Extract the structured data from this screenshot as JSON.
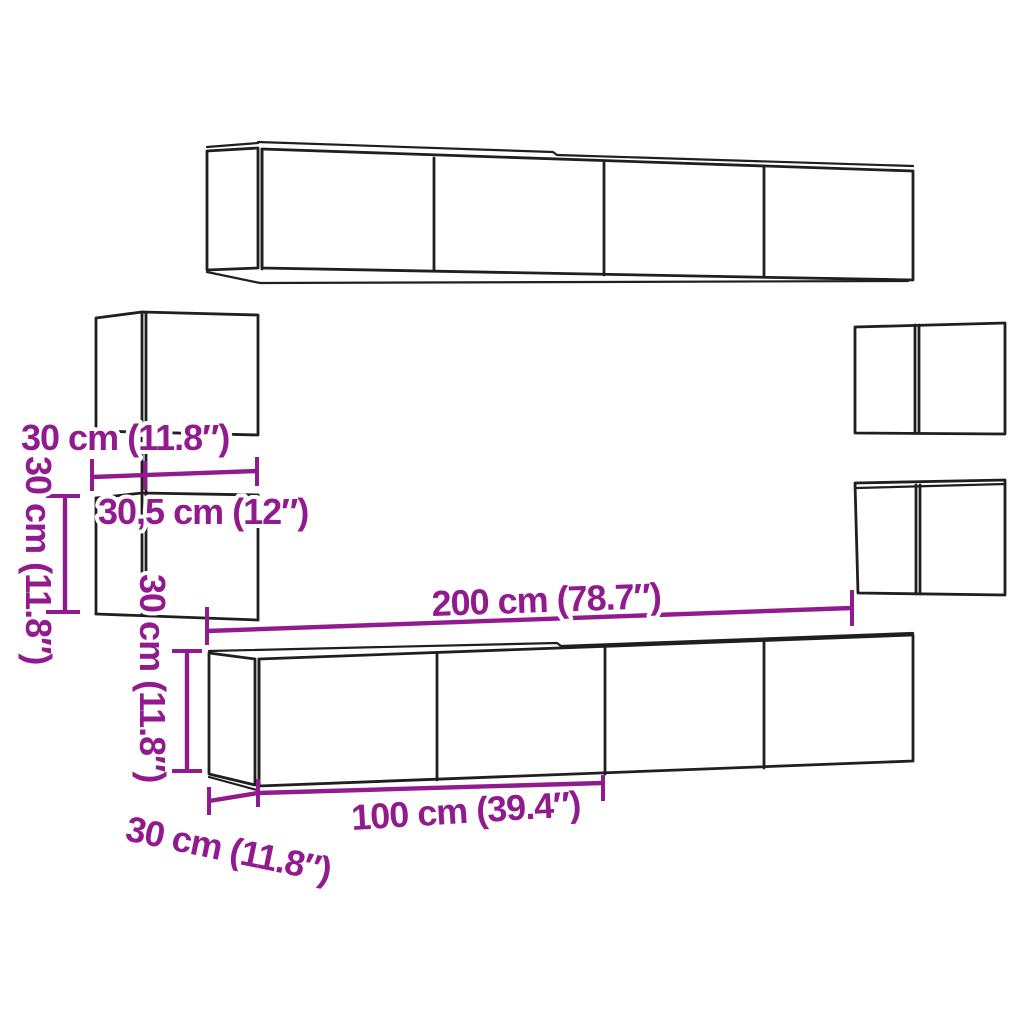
{
  "diagram": {
    "title": "Wall-mounted TV cabinet set dimension diagram",
    "colors": {
      "dimension": "#911B8E",
      "outline": "#1F1F1F",
      "background": "#FFFFFF"
    },
    "labels": {
      "upper_left_cabinet_depth": "30 cm (11.8″)",
      "upper_left_cabinet_width": "30,5 cm (12″)",
      "lower_left_cabinet_height": "30 cm (11.8″)",
      "tv_bench_height": "30 cm (11.8″)",
      "tv_bench_width": "200 cm (78.7″)",
      "tv_bench_half_width": "100 cm (39.4″)",
      "tv_bench_depth": "30 cm (11.8″)"
    }
  }
}
